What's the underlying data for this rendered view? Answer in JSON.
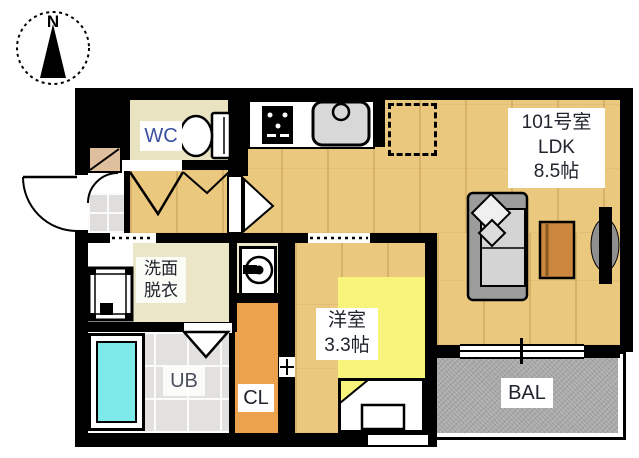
{
  "plan": {
    "compass": {
      "label": "N"
    },
    "unit_label": {
      "line1": "101号室",
      "line2": "LDK",
      "line3": "8.5帖"
    },
    "rooms": {
      "wc": {
        "label": "WC"
      },
      "senmen": {
        "line1": "洗面",
        "line2": "脱衣"
      },
      "ub": {
        "label": "UB"
      },
      "cl": {
        "label": "CL"
      },
      "yoshitsu": {
        "line1": "洋室",
        "line2": "3.3帖"
      },
      "bal": {
        "label": "BAL"
      }
    },
    "icons": {
      "compass": "compass-north-icon",
      "toilet": "toilet-icon",
      "stove": "stove-icon",
      "sink": "kitchen-sink-icon",
      "fridge": "refrigerator-space",
      "sofa": "sofa-icon",
      "table": "low-table-icon",
      "tv": "tv-icon",
      "washer": "washing-machine-icon",
      "basin": "washbasin-icon",
      "bathtub": "bathtub-icon",
      "bed": "bed-icon",
      "shoe_cabinet": "shoe-cabinet-icon"
    },
    "palette": {
      "wall": "#000000",
      "wood_floor": "#eac87d",
      "room_beige": "#e9e3c2",
      "tile_gray": "#e3e1df",
      "closet_orange": "#eca14d",
      "room_yellow": "#f8f37b",
      "balcony_gray": "#a9a9a9",
      "bathtub_cyan": "#7ee9e9",
      "wc_text": "#3b4fa0",
      "label_text": "#20242c",
      "label_bg": "#ffffff"
    }
  }
}
